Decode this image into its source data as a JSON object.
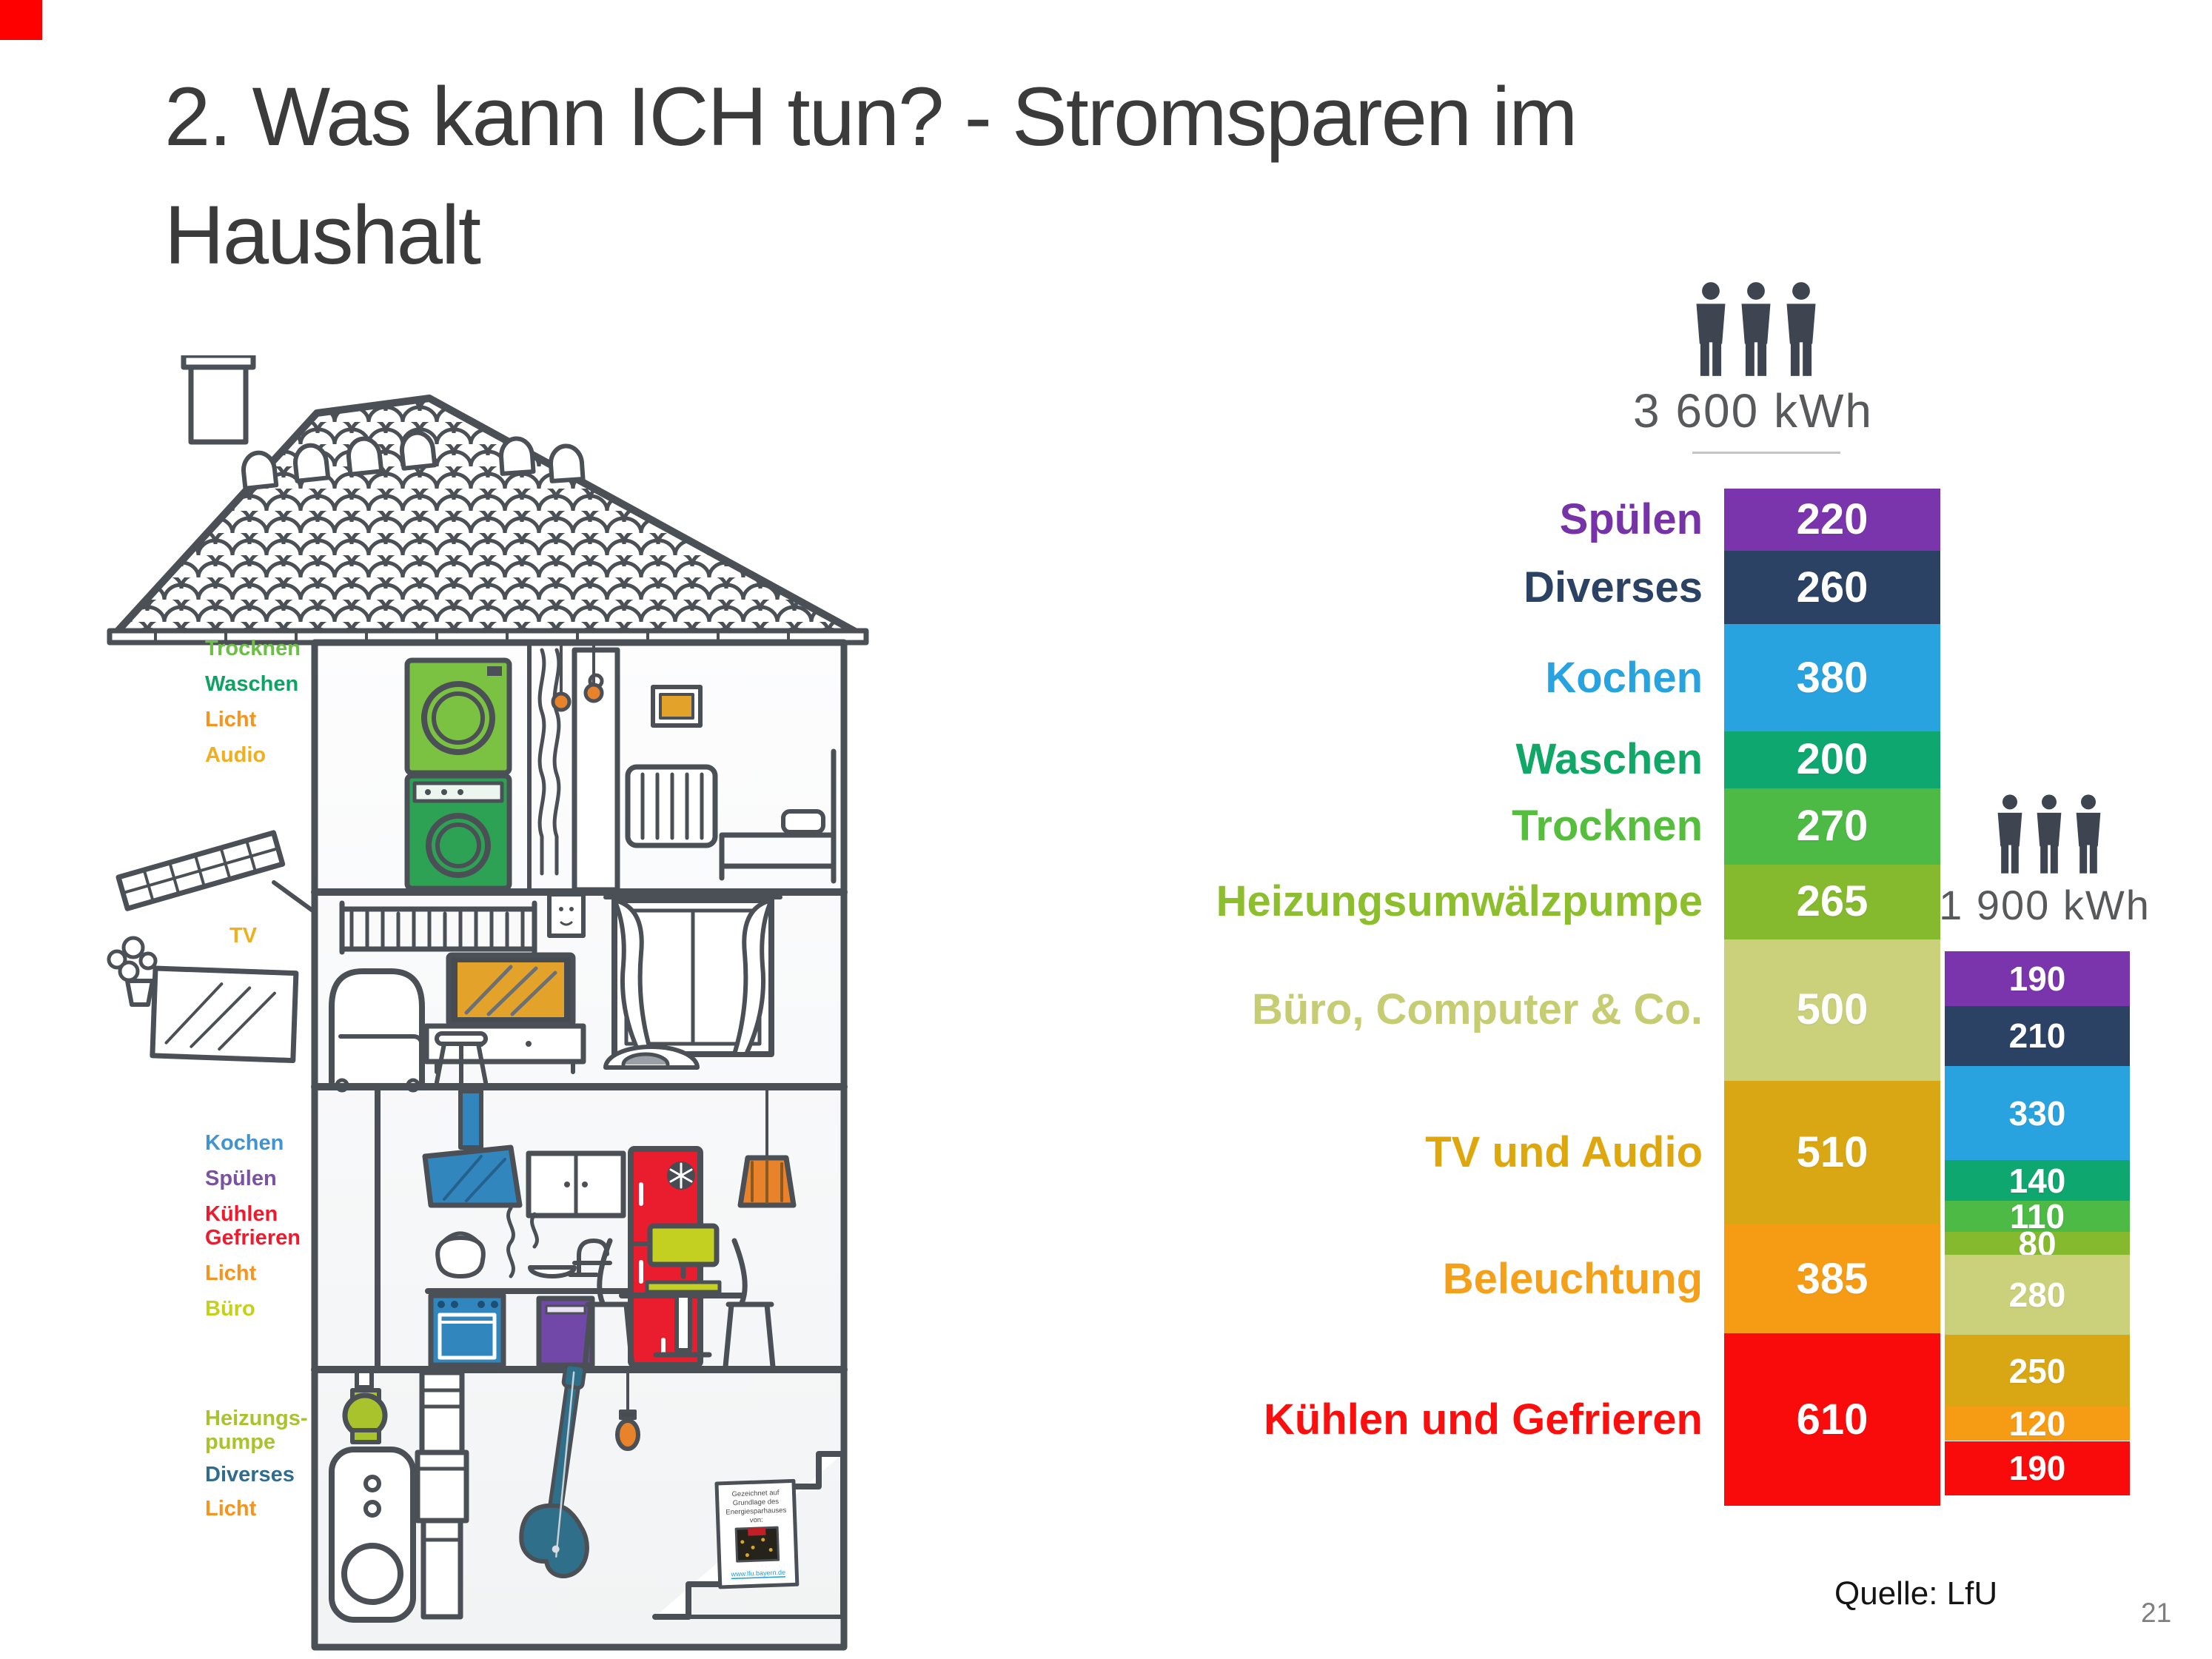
{
  "slide": {
    "title_line1": "2. Was kann ICH tun? - Stromsparen im",
    "title_line2": "Haushalt",
    "source": "Quelle: LfU",
    "page_number": "21",
    "accent_color": "#FF0000"
  },
  "house": {
    "labels": [
      {
        "text": "Trocknen",
        "color": "#6CBE45"
      },
      {
        "text": "Waschen",
        "color": "#0FA264"
      },
      {
        "text": "Licht",
        "color": "#F7941E"
      },
      {
        "text": "Audio",
        "color": "#EFAF21"
      },
      {
        "text": "TV",
        "color": "#EFAF1E"
      },
      {
        "text": "Kochen",
        "color": "#4492CE"
      },
      {
        "text": "Spülen",
        "color": "#7A52A1"
      },
      {
        "text": "Kühlen",
        "color": "#EC1B2D"
      },
      {
        "text": "Gefrieren",
        "color": "#EC1B2D"
      },
      {
        "text": "Licht",
        "color": "#F7941E"
      },
      {
        "text": "Büro",
        "color": "#C5D118"
      },
      {
        "text": "Heizungs-",
        "color": "#A8C32B"
      },
      {
        "text": "pumpe",
        "color": "#A8C32B"
      },
      {
        "text": "Diverses",
        "color": "#2F6C8E"
      },
      {
        "text": "Licht",
        "color": "#F7941E"
      }
    ],
    "caption": {
      "line1": "Gezeichnet auf",
      "line2": "Grundlage des",
      "line3": "Energiesparhauses",
      "line4": "von:",
      "link": "www.lfu.bayern.de"
    }
  },
  "chart_data": {
    "type": "bar",
    "subtype": "stacked-comparison",
    "unit": "kWh",
    "grid": false,
    "legend_position": "left",
    "categories": [
      {
        "label": "Spülen",
        "label_color": "#7633A8",
        "bar_color": "#7A35AD"
      },
      {
        "label": "Diverses",
        "label_color": "#2B4265",
        "bar_color": "#2C4265"
      },
      {
        "label": "Kochen",
        "label_color": "#29A3DF",
        "bar_color": "#29A3DF"
      },
      {
        "label": "Waschen",
        "label_color": "#10A767",
        "bar_color": "#0EA770"
      },
      {
        "label": "Trocknen",
        "label_color": "#55BE3D",
        "bar_color": "#4CBA44"
      },
      {
        "label": "Heizungsumwälzpumpe",
        "label_color": "#8CBE2D",
        "bar_color": "#85B92E"
      },
      {
        "label": "Büro, Computer & Co.",
        "label_color": "#C5CC71",
        "bar_color": "#CBD07B"
      },
      {
        "label": "TV und Audio",
        "label_color": "#DEA70E",
        "bar_color": "#D9A713"
      },
      {
        "label": "Beleuchtung",
        "label_color": "#F5A01B",
        "bar_color": "#F59C14"
      },
      {
        "label": "Kühlen und Gefrieren",
        "label_color": "#FA0F0F",
        "bar_color": "#FA0B0B"
      }
    ],
    "bars": [
      {
        "id": "household-3-persons-unsaving",
        "persons": 3,
        "total": 3600,
        "total_label": "3 600 kWh",
        "values": [
          220,
          260,
          380,
          200,
          270,
          265,
          500,
          510,
          385,
          610
        ]
      },
      {
        "id": "household-3-persons-saving",
        "persons": 3,
        "total": 1900,
        "total_label": "1 900 kWh",
        "values": [
          190,
          210,
          330,
          140,
          110,
          80,
          280,
          250,
          120,
          190
        ]
      }
    ]
  }
}
